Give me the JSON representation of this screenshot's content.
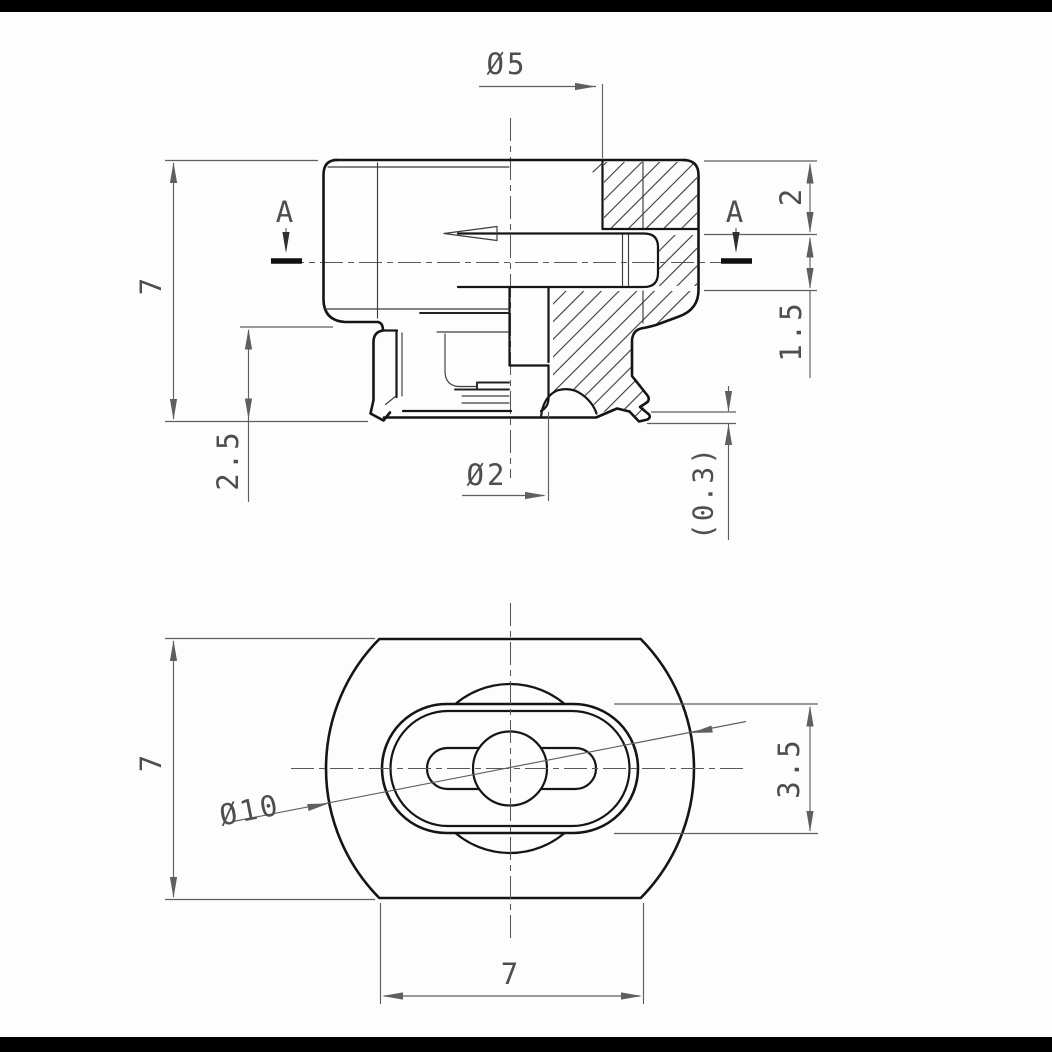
{
  "drawing": {
    "type": "technical-drawing",
    "front_view": {
      "labels": {
        "top_bore_dia": "Ø5",
        "overall_height": "7",
        "lower_height": "2.5",
        "port_top_offset": "2",
        "port_height": "1.5",
        "lip_thickness": "(0.3)",
        "orifice_dia": "Ø2",
        "section_marker_left": "A",
        "section_marker_right": "A"
      }
    },
    "bottom_view": {
      "labels": {
        "pad_dia": "Ø10",
        "flat_height": "7",
        "slot_height": "3.5",
        "slot_width": "7"
      }
    },
    "colors": {
      "outline": "#151515",
      "dimension": "#5f5f5f",
      "hatch": "#3a3a3a",
      "background": "#fdfdfd",
      "frame_bar": "#000000"
    }
  }
}
